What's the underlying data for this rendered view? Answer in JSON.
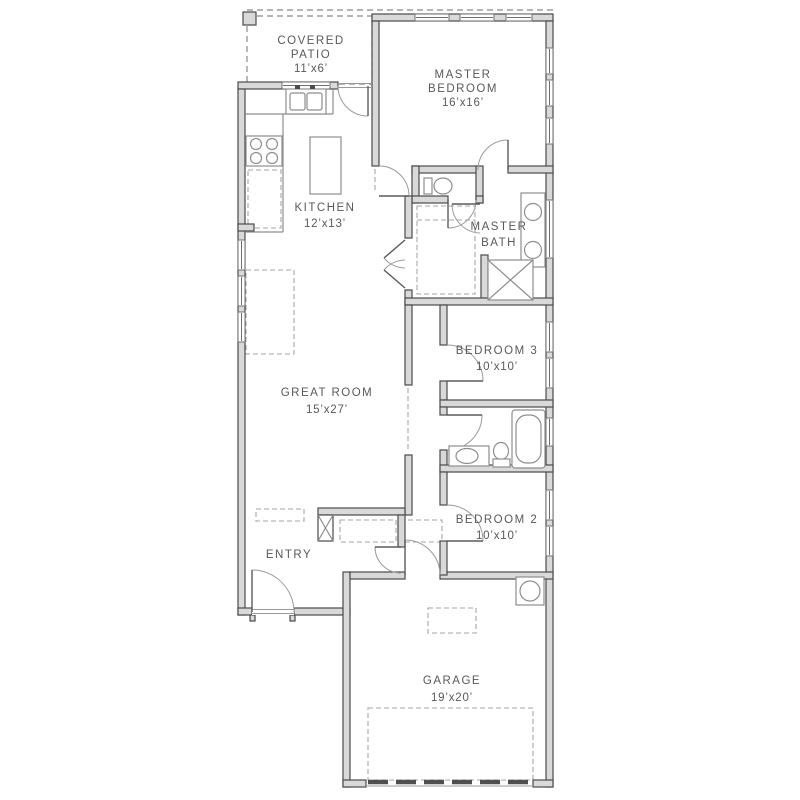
{
  "floorplan": {
    "background": "#ffffff",
    "colors": {
      "wall_fill": "#d9d9d9",
      "wall_stroke": "#4a4a4a",
      "fixture_stroke": "#8e8e8e",
      "dashed_line": "#a5a5a5",
      "label_text": "#58595b"
    },
    "rooms": [
      {
        "id": "covered-patio",
        "lines": [
          "COVERED",
          "PATIO"
        ],
        "dims": "11’x6’"
      },
      {
        "id": "master-bedroom",
        "lines": [
          "MASTER",
          "BEDROOM"
        ],
        "dims": "16’x16’"
      },
      {
        "id": "kitchen",
        "lines": [
          "KITCHEN"
        ],
        "dims": "12’x13’"
      },
      {
        "id": "master-bath",
        "lines": [
          "MASTER",
          "BATH"
        ],
        "dims": ""
      },
      {
        "id": "great-room",
        "lines": [
          "GREAT ROOM"
        ],
        "dims": "15’x27’"
      },
      {
        "id": "bedroom-3",
        "lines": [
          "BEDROOM 3"
        ],
        "dims": "10’x10’"
      },
      {
        "id": "bedroom-2",
        "lines": [
          "BEDROOM 2"
        ],
        "dims": "10’x10’"
      },
      {
        "id": "entry",
        "lines": [
          "ENTRY"
        ],
        "dims": ""
      },
      {
        "id": "garage",
        "lines": [
          "GARAGE"
        ],
        "dims": "19’x20’"
      }
    ],
    "fixtures": [
      "kitchen-sink",
      "cooktop",
      "kitchen-island",
      "master-toilet",
      "master-vanity",
      "shower",
      "master-closet-shelves",
      "bathtub",
      "hall-bath-vanity",
      "hall-bath-toilet",
      "water-heater",
      "coat-closet",
      "garage-door",
      "patio-post"
    ]
  }
}
